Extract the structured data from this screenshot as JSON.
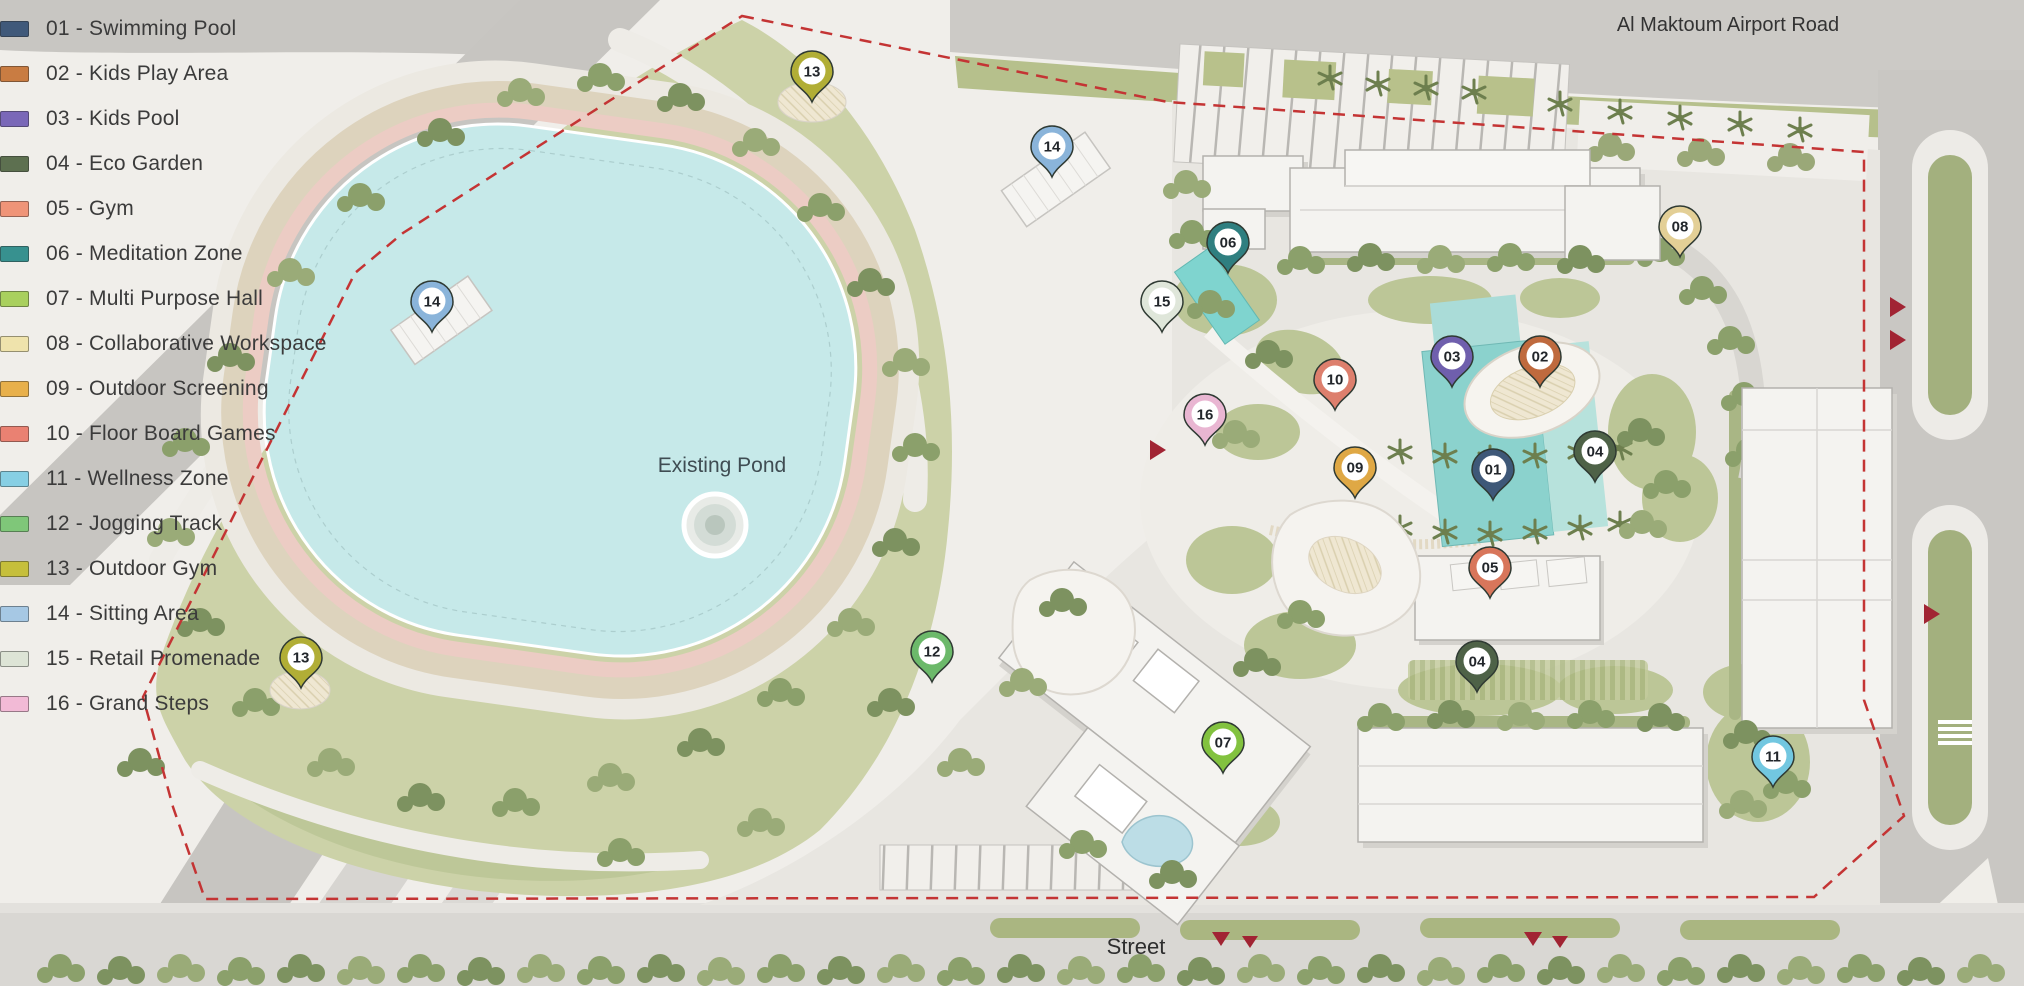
{
  "legend": {
    "items": [
      {
        "text": "01 - Swimming Pool",
        "color": "#40597a"
      },
      {
        "text": "02 - Kids Play Area",
        "color": "#c97c42"
      },
      {
        "text": "03 - Kids Pool",
        "color": "#7a68b8"
      },
      {
        "text": "04 - Eco Garden",
        "color": "#5d7050"
      },
      {
        "text": "05 - Gym",
        "color": "#ef9478"
      },
      {
        "text": "06 - Meditation Zone",
        "color": "#37918f"
      },
      {
        "text": "07 - Multi Purpose Hall",
        "color": "#a9d05e"
      },
      {
        "text": "08 - Collaborative Workspace",
        "color": "#efe3ac"
      },
      {
        "text": "09 - Outdoor Screening",
        "color": "#e8b04b"
      },
      {
        "text": "10 - Floor Board Games",
        "color": "#ea8172"
      },
      {
        "text": "11 - Wellness Zone",
        "color": "#87cfe4"
      },
      {
        "text": "12 - Jogging Track",
        "color": "#7fc779"
      },
      {
        "text": "13 - Outdoor Gym",
        "color": "#c6bf3b"
      },
      {
        "text": "14 - Sitting Area",
        "color": "#a6c8e4"
      },
      {
        "text": "15 - Retail Promenade",
        "color": "#dde4d6"
      },
      {
        "text": "16 - Grand Steps",
        "color": "#f2bad6"
      }
    ]
  },
  "map": {
    "labels": {
      "airport_road": "Al Maktoum Airport Road",
      "existing_pond": "Existing Pond",
      "street": "Street"
    },
    "boundary_color": "#c43434",
    "pins": [
      {
        "num": "01",
        "label": "Swimming Pool",
        "x": 1493,
        "y": 470,
        "color": "#3e5878"
      },
      {
        "num": "02",
        "label": "Kids Play Area",
        "x": 1540,
        "y": 357,
        "color": "#bf6a3e"
      },
      {
        "num": "03",
        "label": "Kids Pool",
        "x": 1452,
        "y": 357,
        "color": "#6f5fad"
      },
      {
        "num": "04",
        "label": "Eco Garden",
        "x": 1595,
        "y": 452,
        "color": "#4e6247"
      },
      {
        "num": "04",
        "label": "Eco Garden",
        "x": 1477,
        "y": 662,
        "color": "#4e6247"
      },
      {
        "num": "05",
        "label": "Gym",
        "x": 1490,
        "y": 568,
        "color": "#d8765b"
      },
      {
        "num": "06",
        "label": "Meditation Zone",
        "x": 1228,
        "y": 243,
        "color": "#2f7f80"
      },
      {
        "num": "07",
        "label": "Multi Purpose Hall",
        "x": 1223,
        "y": 743,
        "color": "#82c23f"
      },
      {
        "num": "08",
        "label": "Collaborative Workspace",
        "x": 1680,
        "y": 227,
        "color": "#e3cf96"
      },
      {
        "num": "09",
        "label": "Outdoor Screening",
        "x": 1355,
        "y": 468,
        "color": "#dfa845"
      },
      {
        "num": "10",
        "label": "Floor Board Games",
        "x": 1335,
        "y": 380,
        "color": "#dd7f6d"
      },
      {
        "num": "11",
        "label": "Wellness Zone",
        "x": 1773,
        "y": 757,
        "color": "#72c7e0"
      },
      {
        "num": "12",
        "label": "Jogging Track",
        "x": 932,
        "y": 652,
        "color": "#6cb96a"
      },
      {
        "num": "13",
        "label": "Outdoor Gym",
        "x": 812,
        "y": 72,
        "color": "#b1ae36"
      },
      {
        "num": "13",
        "label": "Outdoor Gym",
        "x": 301,
        "y": 658,
        "color": "#b1ae36"
      },
      {
        "num": "14",
        "label": "Sitting Area",
        "x": 1052,
        "y": 147,
        "color": "#8ab4da"
      },
      {
        "num": "14",
        "label": "Sitting Area",
        "x": 432,
        "y": 302,
        "color": "#8ab4da"
      },
      {
        "num": "15",
        "label": "Retail Promenade",
        "x": 1162,
        "y": 302,
        "color": "#dfe6da"
      },
      {
        "num": "16",
        "label": "Grand Steps",
        "x": 1205,
        "y": 415,
        "color": "#e9b6d2"
      }
    ]
  }
}
